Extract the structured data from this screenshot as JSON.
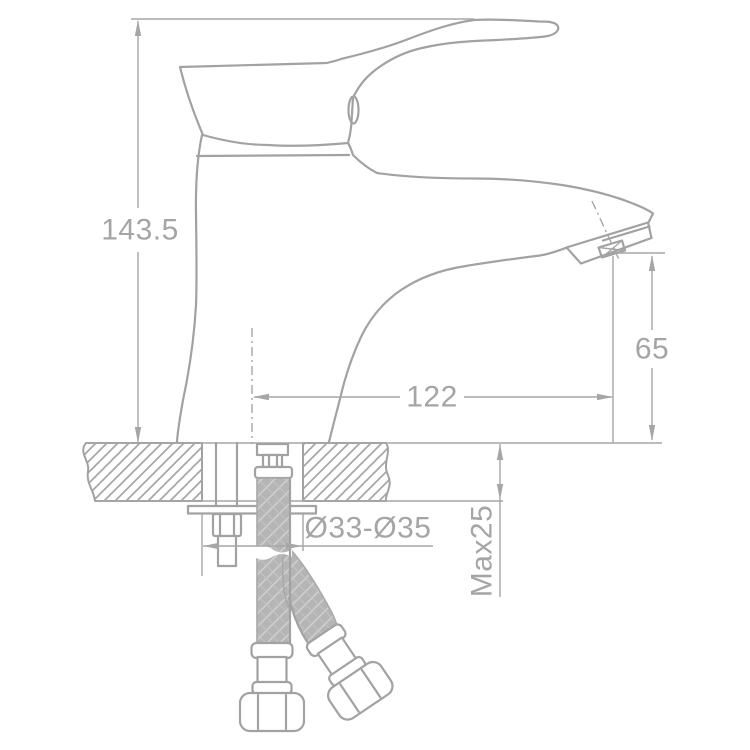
{
  "figure": {
    "type": "technical-dimension-drawing",
    "subject": "single-lever basin faucet, side elevation with mounting cross-section and flexible supply hoses"
  },
  "dims": {
    "total_height": "143.5",
    "spout_reach": "122",
    "outlet_height": "65",
    "max_deck_thickness": "Max25",
    "mounting_hole_diameter": "Ø33-Ø35"
  },
  "colors": {
    "line": "#a2a2a2",
    "dim_line": "#a6a6a6",
    "text": "#a5a5a5",
    "braid_fill": "#b5b5b5",
    "braid_weave": "#cfcfcf",
    "background": "#ffffff"
  }
}
